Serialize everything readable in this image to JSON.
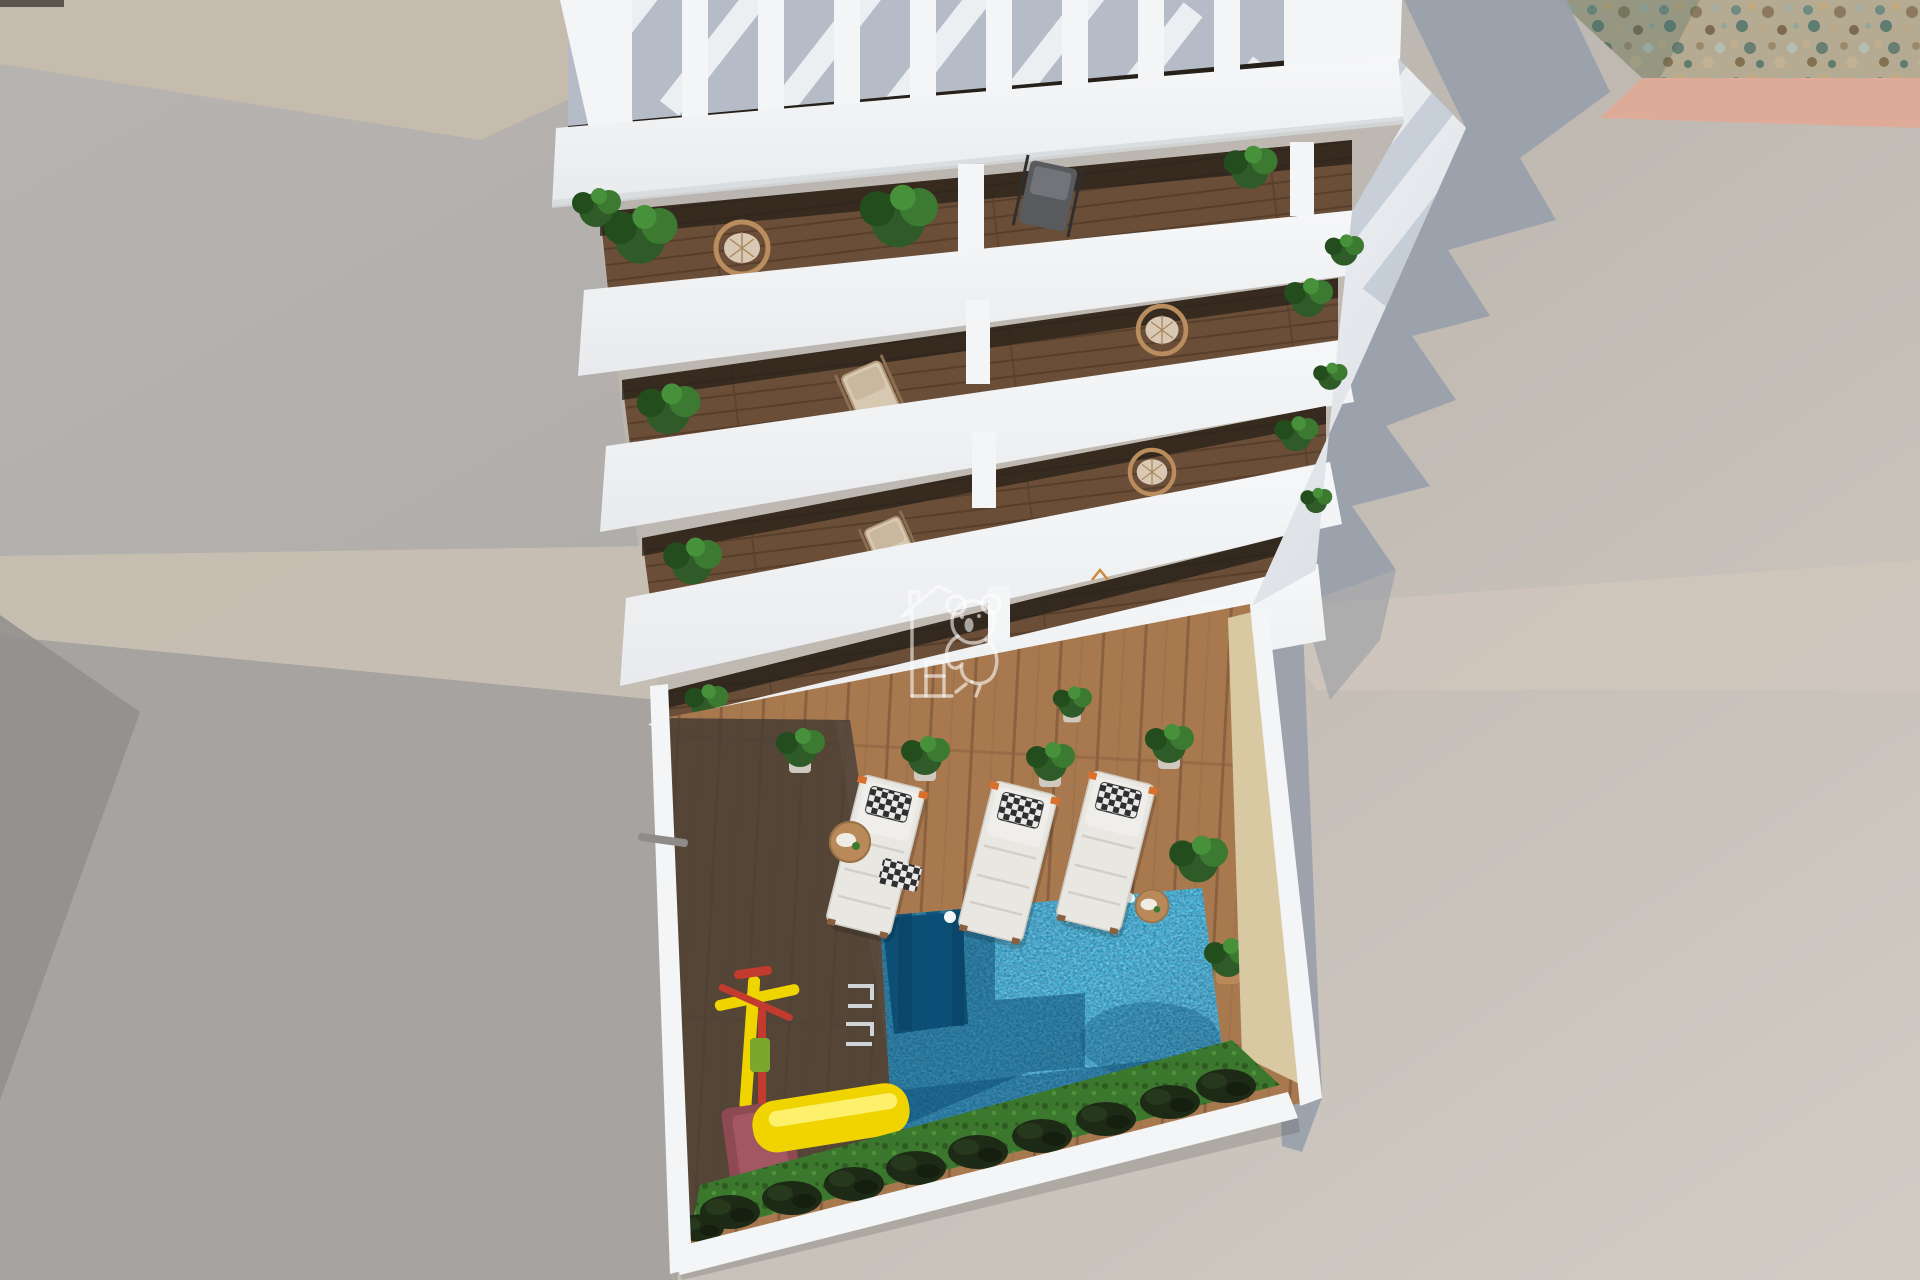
{
  "meta": {
    "title": "aerial-3d-architectural-render",
    "description": "Top-down 3D render of a white apartment tower with slatted roof pergola, four balcony floors with plants and chairs, large cast shadow with sawtooth edge, and a courtyard with swimming pool, sun loungers and a children's slide.",
    "visible_text": []
  },
  "palette": {
    "beige-band": "#c6bcae",
    "warm-band": "#c9c0b2",
    "low-gray": "#a7a3a0",
    "dark-wedge": "#918e8b",
    "salmon-wall": "#dfab99",
    "cast-shadow": "#99a0ab",
    "building-white": "#f4f5f6",
    "pergola-gap": "#b5bcc8",
    "interior-dark": "#262019",
    "deck-shadow": "#463c33",
    "pool-lit": "#17a9da",
    "pool-deep": "#0f85b4",
    "pool-shadow": "#0a4a70",
    "sand-strip": "#d9c9a2",
    "grass-green": "#3c772e",
    "shrub-dark": "#1c2a16",
    "slide-yellow": "#f0d400",
    "slide-base-red": "#8e4a52",
    "gym-red": "#c23b2e",
    "gym-seat-green": "#7aa82c",
    "lounger-white": "#e9e7e2",
    "accent-orange": "#d9702c",
    "rattan": "#b98d5e",
    "cushion-beige": "#d9c9b4",
    "table-wood": "#b9895a",
    "watermark": "#ffffff"
  },
  "scene": {
    "environment": {
      "left_wall": "neighbour rooftop wall, flat grey with beige top band",
      "right_ground": "sunlit concrete ground",
      "gravel_strip": "pebble gravel in top-right corner",
      "salmon_wall_top": "pink wall cap under gravel",
      "building_shadow": "blue-grey cast shadow with sawtooth balcony edge"
    },
    "building": {
      "roof": "white pergola with 10 slats",
      "balcony_floors": 4,
      "balcony_contents": [
        "palm plants",
        "banana plants",
        "rattan ring chairs",
        "folding deck chairs",
        "grey lounge chair"
      ],
      "divider_posts_per_floor": 2
    },
    "courtyard": {
      "deck": "wood plank deck, half in shadow",
      "pool": {
        "shape": "rectangle",
        "steps": "top-left corner",
        "ladder": "left edge",
        "underwater_lights": 2
      },
      "sun_loungers": 3,
      "side_tables": 2,
      "potted_plants": 7,
      "playground": [
        "yellow-red gym frame",
        "yellow slide with red base"
      ],
      "planting": "grass strip with dark shrubs along lower wall"
    },
    "watermark": {
      "icon": "koala-climbing-house-logo",
      "opacity": 0.58,
      "position": "center"
    }
  }
}
